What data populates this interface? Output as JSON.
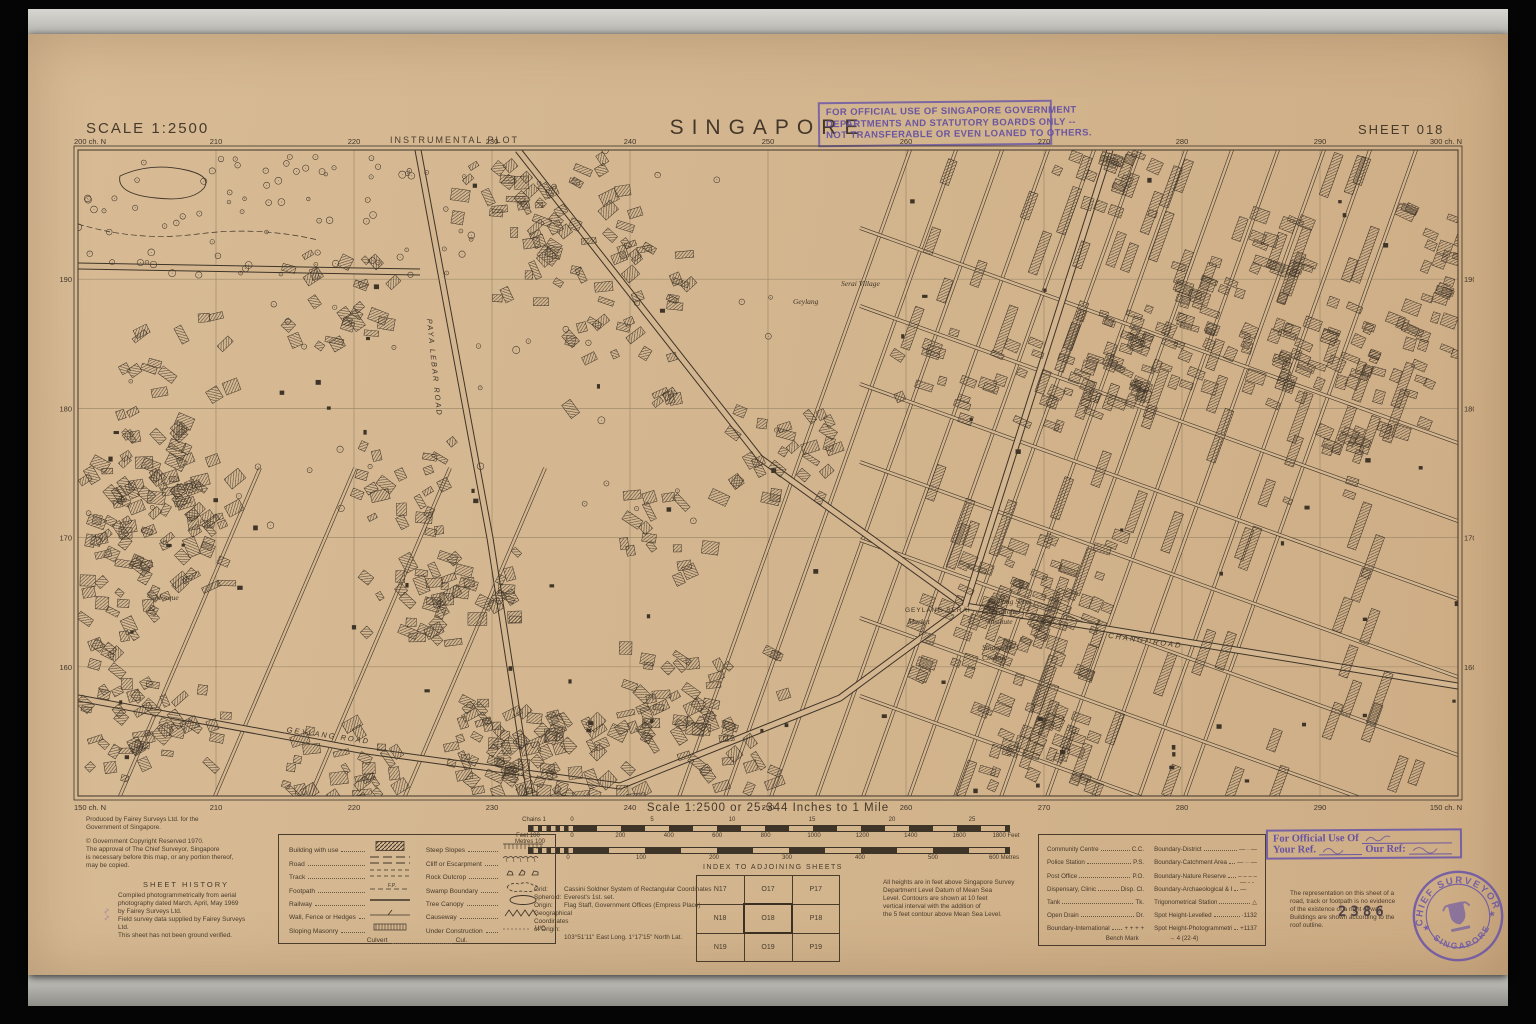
{
  "header": {
    "scale_label": "SCALE 1:2500",
    "plot_type": "INSTRUMENTAL PLOT",
    "title": "SINGAPORE",
    "sheet_label": "SHEET 018"
  },
  "official_stamp_top": [
    "FOR OFFICIAL USE OF SINGAPORE GOVERNMENT",
    "DEPARTMENTS AND STATUTORY BOARDS ONLY --",
    "NOT TRANSFERABLE OR EVEN LOANED TO OTHERS."
  ],
  "map": {
    "corner_top_left": "200 ch. N",
    "corner_top_right": "300 ch. N",
    "corner_bottom_left": "150 ch. N",
    "corner_bottom_right": "150 ch. N",
    "top_ticks": [
      "210",
      "220",
      "230",
      "240",
      "250",
      "260",
      "270",
      "280",
      "290"
    ],
    "bottom_ticks": [
      "210",
      "220",
      "230",
      "240",
      "250",
      "260",
      "270",
      "280",
      "290"
    ],
    "left_ticks": [
      "190",
      "180",
      "170",
      "160"
    ],
    "right_ticks": [
      "190",
      "180",
      "170",
      "160"
    ],
    "place_labels": [
      {
        "text": "Serai Village",
        "x": 781,
        "y": 148,
        "style": "serif"
      },
      {
        "text": "Geylang",
        "x": 733,
        "y": 166,
        "style": "serif"
      },
      {
        "text": "Mosque",
        "x": 95,
        "y": 462,
        "style": "serif"
      },
      {
        "text": "GEYLANG  SERAI",
        "x": 845,
        "y": 474,
        "style": "caps"
      },
      {
        "text": "Market",
        "x": 848,
        "y": 486,
        "style": "serif"
      },
      {
        "text": "Geylang Serai",
        "x": 928,
        "y": 466,
        "style": "serif"
      },
      {
        "text": "Vocational",
        "x": 928,
        "y": 476,
        "style": "serif"
      },
      {
        "text": "Institute",
        "x": 928,
        "y": 486,
        "style": "serif"
      },
      {
        "text": "Singapore",
        "x": 922,
        "y": 512,
        "style": "serif"
      },
      {
        "text": "Cinema",
        "x": 922,
        "y": 522,
        "style": "serif"
      },
      {
        "text": "GEYLANG ROAD",
        "x": 268,
        "y": 600,
        "style": "road",
        "rot": 8
      },
      {
        "text": "CHANGI ROAD",
        "x": 1085,
        "y": 505,
        "style": "road",
        "rot": 8
      },
      {
        "text": "PAYA LEBAR ROAD",
        "x": 372,
        "y": 230,
        "style": "road",
        "rot": 84
      }
    ]
  },
  "scalebar": {
    "title": "Scale 1:2500 or 25·344 Inches to 1 Mile",
    "chains_left": "Chains 1",
    "chains_ticks": [
      "0",
      "5",
      "10",
      "15",
      "20",
      "25"
    ],
    "feet_left": "Feet 100",
    "feet_ticks": [
      "0",
      "200",
      "400",
      "600",
      "800",
      "1000",
      "1200",
      "1400",
      "1600"
    ],
    "feet_right": "1800 Feet",
    "metres_left": "Metres 100",
    "metres_ticks": [
      "0",
      "100",
      "200",
      "300",
      "400",
      "500"
    ],
    "metres_right": "600 Metres"
  },
  "credits": {
    "produced_lines": [
      "Produced by Fairey Surveys Ltd. for the",
      "Government of Singapore."
    ],
    "copyright_lines": [
      "© Government Copyright Reserved 1970.",
      "The approval of The Chief Surveyor, Singapore",
      "is necessary before this map, or any portion thereof,",
      "may be copied."
    ]
  },
  "sheet_history": {
    "title": "SHEET HISTORY",
    "lines": [
      "Compiled photogrammetrically from aerial",
      "photography dated March, April, May 1969",
      "by Fairey Surveys Ltd.",
      "Field survey data supplied by Fairey Surveys",
      "Ltd.",
      "This sheet has not been ground verified."
    ]
  },
  "legend": {
    "left": [
      {
        "label": "Building with use",
        "sym": "building",
        "abbr": ""
      },
      {
        "label": "Road",
        "sym": "road",
        "abbr": ""
      },
      {
        "label": "Track",
        "sym": "track",
        "abbr": ""
      },
      {
        "label": "Footpath",
        "sym": "footpath",
        "abbr": "F.P."
      },
      {
        "label": "Railway",
        "sym": "railway",
        "abbr": ""
      },
      {
        "label": "Wall, Fence or Hedges",
        "sym": "fence",
        "abbr": ""
      },
      {
        "label": "Sloping Masonry",
        "sym": "masonry",
        "abbr": ""
      }
    ],
    "right": [
      {
        "label": "Steep Slopes",
        "sym": "steep",
        "abbr": ""
      },
      {
        "label": "Cliff or Escarpment",
        "sym": "cliff",
        "abbr": ""
      },
      {
        "label": "Rock Outcrop",
        "sym": "rock",
        "abbr": ""
      },
      {
        "label": "Swamp Boundary",
        "sym": "swamp",
        "abbr": ""
      },
      {
        "label": "Tree Canopy",
        "sym": "canopy",
        "abbr": ""
      },
      {
        "label": "Causeway",
        "sym": "causeway",
        "abbr": ""
      },
      {
        "label": "Under Construction",
        "sym": "uc",
        "abbr": "U/C"
      }
    ],
    "culvert_label": "Culvert",
    "culvert_abbr": "Cul."
  },
  "grid_notes": [
    {
      "k": "Grid:",
      "v": "Cassini Soldner System of Rectangular Coordinates"
    },
    {
      "k": "Spheroid:",
      "v": "Everest's 1st. set."
    },
    {
      "k": "Origin:",
      "v": "Flag Staff, Government Offices (Empress Place)"
    },
    {
      "k": "Geographical Coordinates of Origin:",
      "v": ""
    },
    {
      "k": "",
      "v": "103°51'11\" East Long.   1°17'15\" North Lat."
    }
  ],
  "index_sheets": {
    "title": "INDEX TO ADJOINING SHEETS",
    "rows": [
      [
        "N17",
        "O17",
        "P17"
      ],
      [
        "N18",
        "O18",
        "P18"
      ],
      [
        "N19",
        "O19",
        "P19"
      ]
    ],
    "current": "O18"
  },
  "heights_note": [
    "All heights are in feet above Singapore Survey",
    "Department Level Datum of Mean Sea",
    "Level. Contours are shown at 10 feet",
    "vertical interval with the addition of",
    "the 5 feet contour above Mean Sea Level."
  ],
  "abbreviations": {
    "left": [
      {
        "label": "Community Centre",
        "abbr": "C.C."
      },
      {
        "label": "Police Station",
        "abbr": "P.S."
      },
      {
        "label": "Post Office",
        "abbr": "P.O."
      },
      {
        "label": "Dispensary, Clinic",
        "abbr": "Disp. Cl."
      },
      {
        "label": "Tank",
        "abbr": "Tk."
      },
      {
        "label": "Open Drain",
        "abbr": "Dr."
      },
      {
        "label": "Boundary-International",
        "abbr": "+ + + +"
      }
    ],
    "right": [
      {
        "label": "Boundary-District",
        "abbr": "— · —"
      },
      {
        "label": "Boundary-Catchment Area",
        "abbr": "— ·· —"
      },
      {
        "label": "Boundary-Nature Reserve",
        "abbr": "– – – –"
      },
      {
        "label": "Boundary-Archaeological & Port Limits",
        "abbr": "— - - —"
      },
      {
        "label": "Trigonometrical Station",
        "abbr": "△"
      },
      {
        "label": "Spot Height-Levelled",
        "abbr": "·1132"
      },
      {
        "label": "Spot Height-Photogrammetric",
        "abbr": "+1137"
      }
    ],
    "bench_mark_label": "Bench Mark",
    "bench_mark_abbr": "→ 4 (22·4)"
  },
  "refs_stamp": {
    "line1": "For Official Use Of",
    "line2a": "Your Ref.",
    "line2b": "Our Ref:"
  },
  "rep_note": [
    "The representation on this sheet of a",
    "road, track or footpath is no evidence",
    "of the existence of a right of way.",
    "Buildings are shown according to the",
    "roof outline."
  ],
  "round_stamp": {
    "arc_top": "CHIEF SURVEYOR",
    "arc_bottom": "SINGAPORE"
  },
  "serial": "2386",
  "colors": {
    "paper": "#d3b68f",
    "ink": "#3f3428",
    "stamp_purple": "#6854a8",
    "grid_line": "#a08b6b",
    "serial_ink": "#4d4147"
  }
}
